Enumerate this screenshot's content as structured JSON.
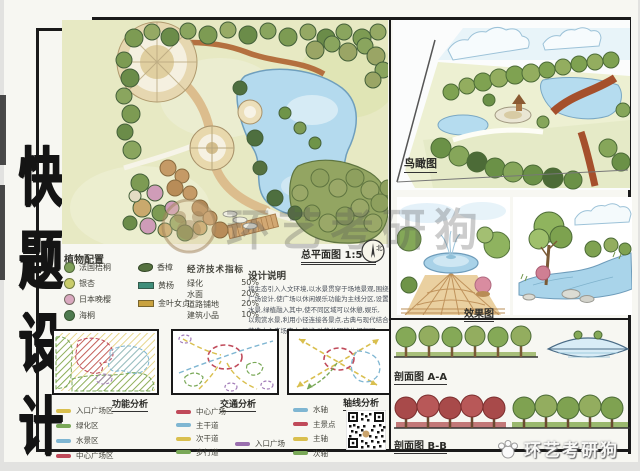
{
  "page": {
    "paper_color": "#f7f7f2",
    "frame_color": "#1a1a1a"
  },
  "title_block": {
    "text": "快题设计",
    "chars": [
      "快",
      "题",
      "设",
      "计"
    ]
  },
  "master_plan": {
    "caption": "总平面图 1:500",
    "north_label": "北"
  },
  "plant_legend": {
    "title": "植物配置",
    "col1": [
      {
        "name": "法国梧桐",
        "color": "#7fa05a"
      },
      {
        "name": "银杏",
        "color": "#c9cc6a"
      },
      {
        "name": "日本晚樱",
        "color": "#d9a8bf"
      },
      {
        "name": "海桐",
        "color": "#4e7a4f"
      }
    ],
    "col2": [
      {
        "name": "香樟",
        "color": "#55713f"
      },
      {
        "name": "黄杨",
        "color": "#3f8e7a"
      },
      {
        "name": "金叶女贞",
        "color": "#c9a23f"
      }
    ]
  },
  "indicators": {
    "title": "经济技术指标",
    "rows": [
      {
        "label": "绿化",
        "value": "50%"
      },
      {
        "label": "水面",
        "value": "20%"
      },
      {
        "label": "道路铺地",
        "value": "20%"
      },
      {
        "label": "建筑小品",
        "value": "10%"
      }
    ]
  },
  "description": {
    "title": "设计说明",
    "lines": [
      "将生态引入人文环境,以水景贯穿于场地景观,围绕",
      "广场设计,使广场以休闲娱乐功能为主线分区,设置",
      "水景,绿植融入其中,使不同区域可以休憩,娱乐,",
      "以观赏水景,利用小径连接各景点,古典与现代结合,",
      "营造中心广场宜人,静谧,动静分明的休闲氛围."
    ]
  },
  "analyses": {
    "functional": {
      "title": "功能分析",
      "legend": [
        {
          "label": "入口广场区",
          "color": "#d9bf4e"
        },
        {
          "label": "绿化区",
          "color": "#79a857"
        },
        {
          "label": "水景区",
          "color": "#7fb6d2"
        },
        {
          "label": "中心广场区",
          "color": "#c04a5a"
        }
      ]
    },
    "traffic": {
      "title": "交通分析",
      "legend": [
        {
          "label": "中心广场",
          "color": "#c04a5a"
        },
        {
          "label": "主干道",
          "color": "#7fb6d2"
        },
        {
          "label": "次干道",
          "color": "#d9bf4e"
        },
        {
          "label": "步行道",
          "color": "#79a857"
        },
        {
          "label": "入口广场",
          "color": "#9a6fae"
        }
      ]
    },
    "axis": {
      "title": "轴线分析",
      "legend": [
        {
          "label": "水轴",
          "color": "#7fb6d2"
        },
        {
          "label": "主景点",
          "color": "#c04a5a"
        },
        {
          "label": "主轴",
          "color": "#d9bf4e"
        },
        {
          "label": "次轴",
          "color": "#79a857"
        }
      ]
    }
  },
  "right_panels": {
    "birdseye_label": "鸟瞰图",
    "effect_label": "效果图",
    "section_a_label": "剖面图 A-A",
    "section_b_label": "剖面图 B-B"
  },
  "watermarks": {
    "center": "环艺考研狗",
    "bottom_right": "环艺考研狗"
  }
}
